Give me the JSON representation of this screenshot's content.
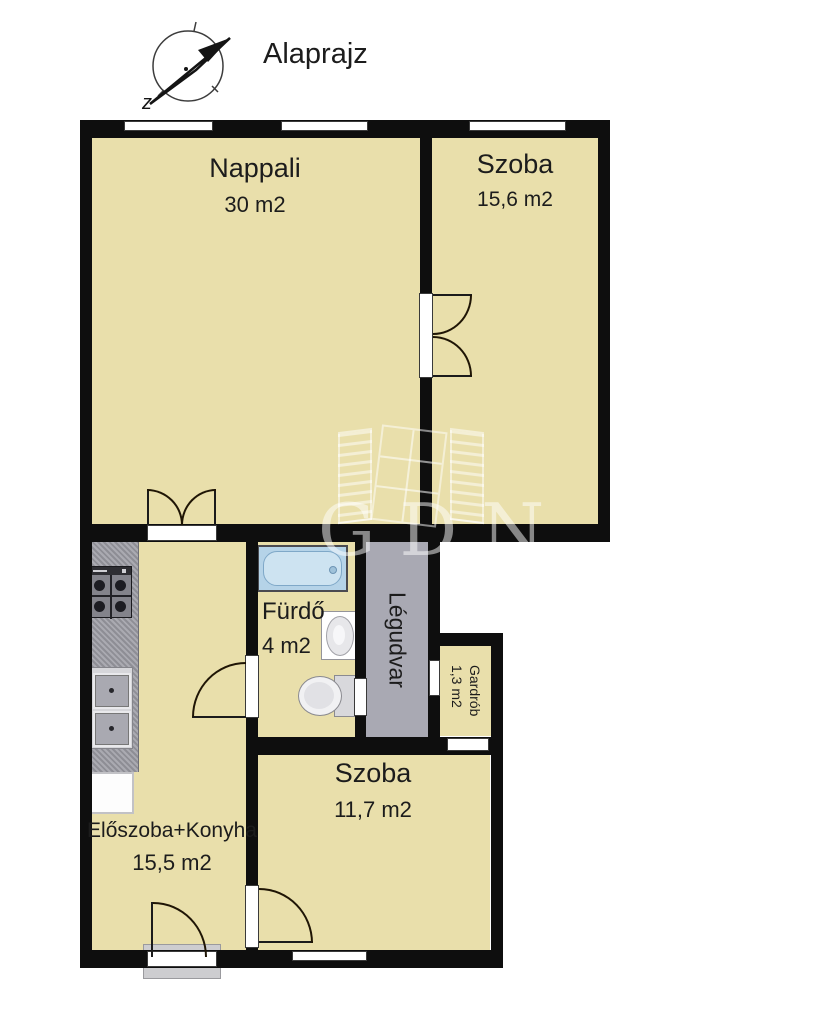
{
  "title": "Alaprajz",
  "compass": {
    "label": "z"
  },
  "watermark": {
    "text": "GDN"
  },
  "rooms": {
    "nappali": {
      "name": "Nappali",
      "area": "30 m2"
    },
    "szoba_top": {
      "name": "Szoba",
      "area": "15,6 m2"
    },
    "furdo": {
      "name": "Fürdő",
      "area": "4 m2"
    },
    "legudvar": {
      "name": "Légudvar"
    },
    "gardrob": {
      "name": "Gardrób",
      "area": "1,3 m2"
    },
    "szoba_bottom": {
      "name": "Szoba",
      "area": "11,7 m2"
    },
    "eloszoba": {
      "name": "Előszoba+Konyha",
      "area": "15,5 m2"
    }
  },
  "colors": {
    "floor": "#e9dfab",
    "wall": "#0e0e0e",
    "lightwell": "#a9a9b3",
    "counter": "#9a9aa2",
    "bathtub": "#b5d3e8",
    "text": "#1c1c1c"
  }
}
